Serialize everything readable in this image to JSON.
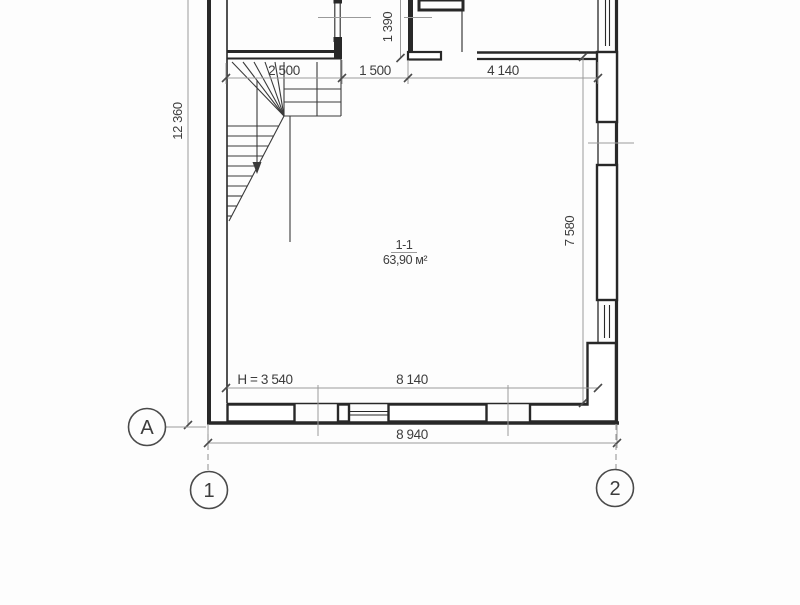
{
  "plan": {
    "room": {
      "number": "1-1",
      "area": "63,90 м²",
      "height_note": "H = 3 540"
    },
    "dimensions": {
      "stair_bay": "2 500",
      "hall": "1 500",
      "main_bay": "4 140",
      "top_offset": "1 390",
      "overall_height": "12 360",
      "right_inner_height": "7 580",
      "inner_width": "8 140",
      "overall_width": "8 940"
    },
    "axes": {
      "letter_a": "A",
      "number_1": "1",
      "number_2": "2"
    },
    "colors": {
      "wall": "#282828",
      "stair": "#3a3a3a",
      "dimension_line": "#9a9a9a",
      "tick": "#4a4a4a",
      "text": "#3d3d3d",
      "background": "#fdfdfd"
    }
  }
}
